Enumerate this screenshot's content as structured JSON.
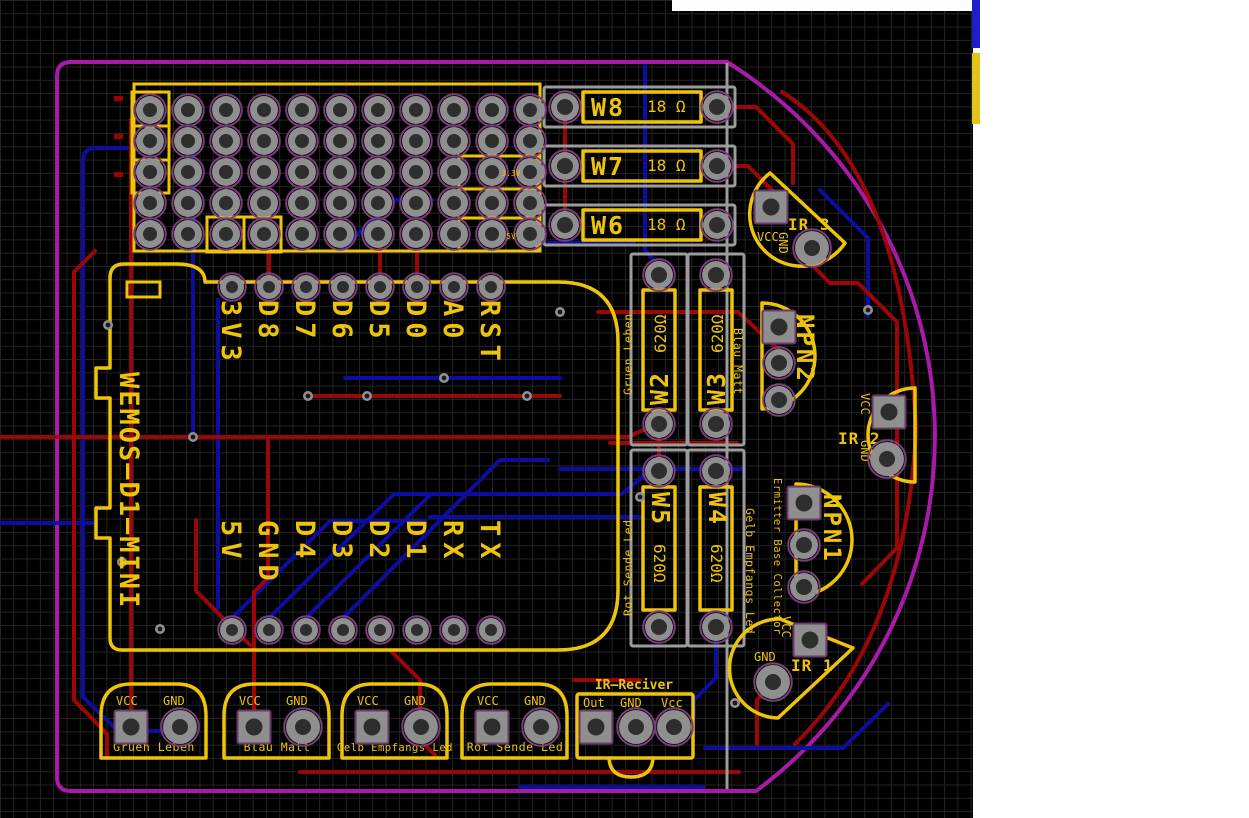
{
  "colors": {
    "background": "#000000",
    "grid": "#242424",
    "silkscreen": "#eec40a",
    "fab_outline": "#9c9c9c",
    "copper_top": "#9b0707",
    "copper_bottom": "#0d0da1",
    "board_edge": "#a81ba8"
  },
  "wemos": {
    "name": "WEMOS—D1—MINI",
    "pins_top": [
      "3V3",
      "D8",
      "D7",
      "D6",
      "D5",
      "D0",
      "A0",
      "RST"
    ],
    "pins_bottom": [
      "5V",
      "GND",
      "D4",
      "D3",
      "D2",
      "D1",
      "RX",
      "TX"
    ]
  },
  "perfboard": {
    "net_3v3": "3.3V",
    "net_5v": "5V"
  },
  "resistors_18": [
    {
      "ref": "W8",
      "value": "18 Ω"
    },
    {
      "ref": "W7",
      "value": "18 Ω"
    },
    {
      "ref": "W6",
      "value": "18 Ω"
    }
  ],
  "resistors_620": [
    {
      "ref": "W2",
      "value": "620Ω"
    },
    {
      "ref": "W3",
      "value": "620Ω"
    },
    {
      "ref": "W5",
      "value": "620Ω"
    },
    {
      "ref": "W4",
      "value": "620Ω"
    }
  ],
  "side_labels": {
    "gruen_leben": "Gruen Leben",
    "blau_matt": "Blau Matt",
    "rot_sende": "Rot Sende Led",
    "gelb_empfangs": "Gelb Empfangs Led",
    "transistor_pinout": "Ermitter Base Collector"
  },
  "ir_sensors": [
    {
      "ref": "IR 3",
      "vcc": "VCC",
      "gnd": "GND"
    },
    {
      "ref": "IR 2",
      "vcc": "VCC",
      "gnd": "GND"
    },
    {
      "ref": "IR 1",
      "vcc": "VCC",
      "gnd": "GND"
    }
  ],
  "transistors": [
    {
      "ref": "NPN2"
    },
    {
      "ref": "NPN1"
    }
  ],
  "connectors": [
    {
      "name": "Gruen Leben",
      "vcc": "VCC",
      "gnd": "GND"
    },
    {
      "name": "Blau Matt",
      "vcc": "VCC",
      "gnd": "GND"
    },
    {
      "name": "Gelb Empfangs Led",
      "vcc": "VCC",
      "gnd": "GND"
    },
    {
      "name": "Rot Sende Led",
      "vcc": "VCC",
      "gnd": "GND"
    }
  ],
  "ir_receiver": {
    "name": "IR—Reciver",
    "pins": [
      "Out",
      "GND",
      "Vcc"
    ]
  }
}
